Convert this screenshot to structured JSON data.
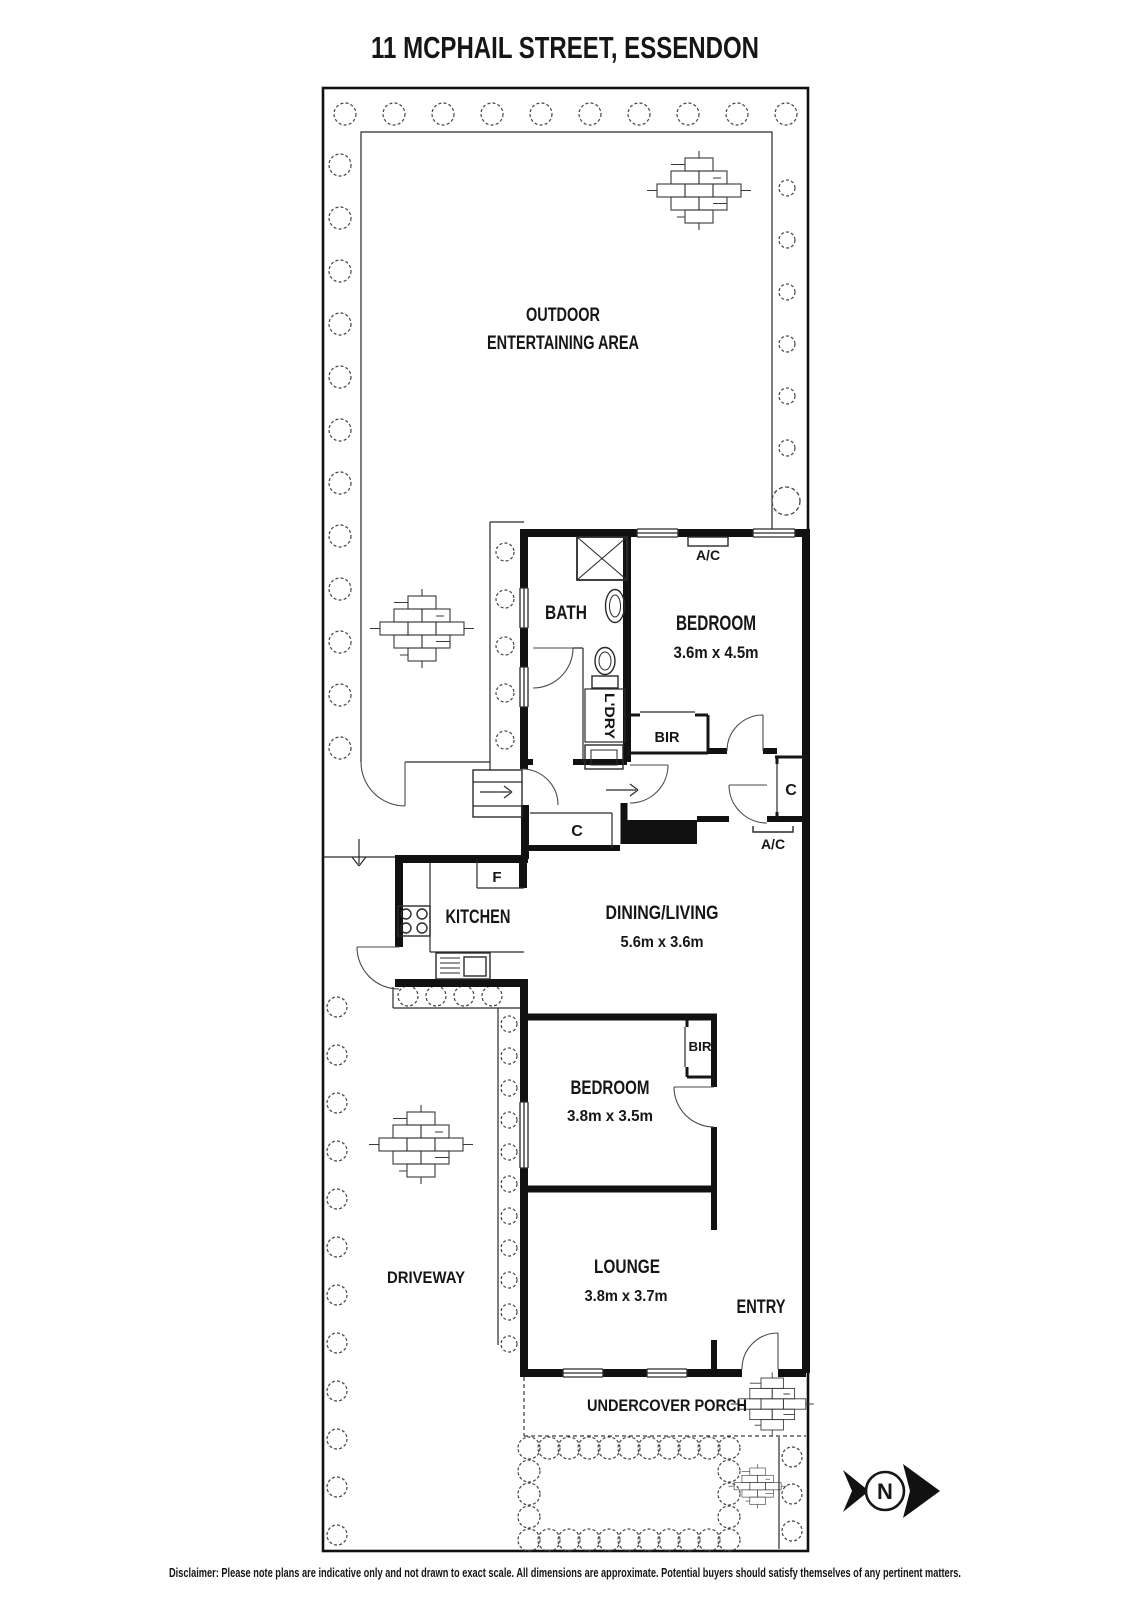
{
  "title": "11 MCPHAIL STREET, ESSENDON",
  "rooms": {
    "outdoor_line1": "OUTDOOR",
    "outdoor_line2": "ENTERTAINING AREA",
    "bath": "BATH",
    "bedroom1": "BEDROOM",
    "bedroom1_dims": "3.6m x 4.5m",
    "laundry": "L'DRY",
    "dining": "DINING/LIVING",
    "dining_dims": "5.6m x 3.6m",
    "kitchen": "KITCHEN",
    "bedroom2": "BEDROOM",
    "bedroom2_dims": "3.8m x 3.5m",
    "lounge": "LOUNGE",
    "lounge_dims": "3.8m x 3.7m",
    "entry": "ENTRY",
    "driveway": "DRIVEWAY",
    "porch": "UNDERCOVER PORCH"
  },
  "fixtures": {
    "ac": "A/C",
    "bir": "BIR",
    "cupboard": "C",
    "fridge": "F"
  },
  "compass": {
    "north": "N"
  },
  "disclaimer": "Disclaimer: Please note plans are indicative only and not drawn to exact scale. All dimensions are approximate. Potential buyers should satisfy themselves of any pertinent matters.",
  "colors": {
    "ink": "#161616",
    "paper": "#ffffff"
  }
}
